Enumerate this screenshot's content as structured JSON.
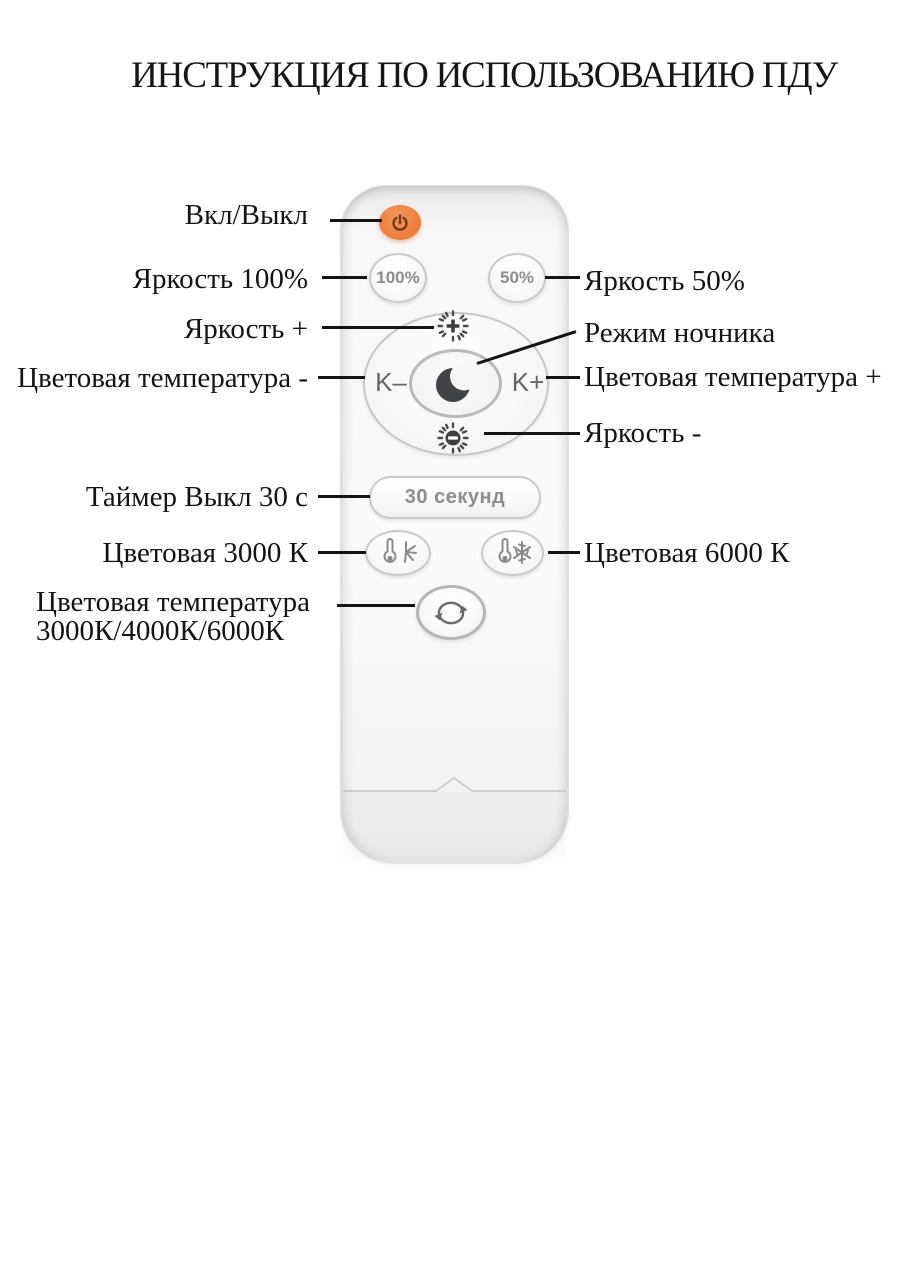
{
  "title": "ИНСТРУКЦИЯ ПО ИСПОЛЬЗОВАНИЮ ПДУ",
  "annotations": {
    "power": "Вкл/Выкл",
    "brightness_100": "Яркость 100%",
    "brightness_plus": "Яркость +",
    "color_temp_minus": "Цветовая температура -",
    "timer_off": "Таймер Выкл 30 с",
    "color_3000": "Цветовая 3000 К",
    "color_temp_cycle_line1": "Цветовая температура",
    "color_temp_cycle_line2": "3000К/4000К/6000К",
    "brightness_50": "Яркость 50%",
    "night_mode": "Режим ночника",
    "color_temp_plus": "Цветовая температура +",
    "brightness_minus": "Яркость -",
    "color_6000": "Цветовая 6000 К"
  },
  "remote": {
    "brightness_100_label": "100%",
    "brightness_50_label": "50%",
    "k_minus_label": "K–",
    "k_plus_label": "K+",
    "timer_label": "30 секунд"
  },
  "colors": {
    "power_button": "#ee8142",
    "power_icon": "#7c3a1d",
    "button_border": "#c9c9c9",
    "button_text": "#8c8c8c",
    "dark_icon": "#3f4347",
    "line_color": "#141414"
  }
}
